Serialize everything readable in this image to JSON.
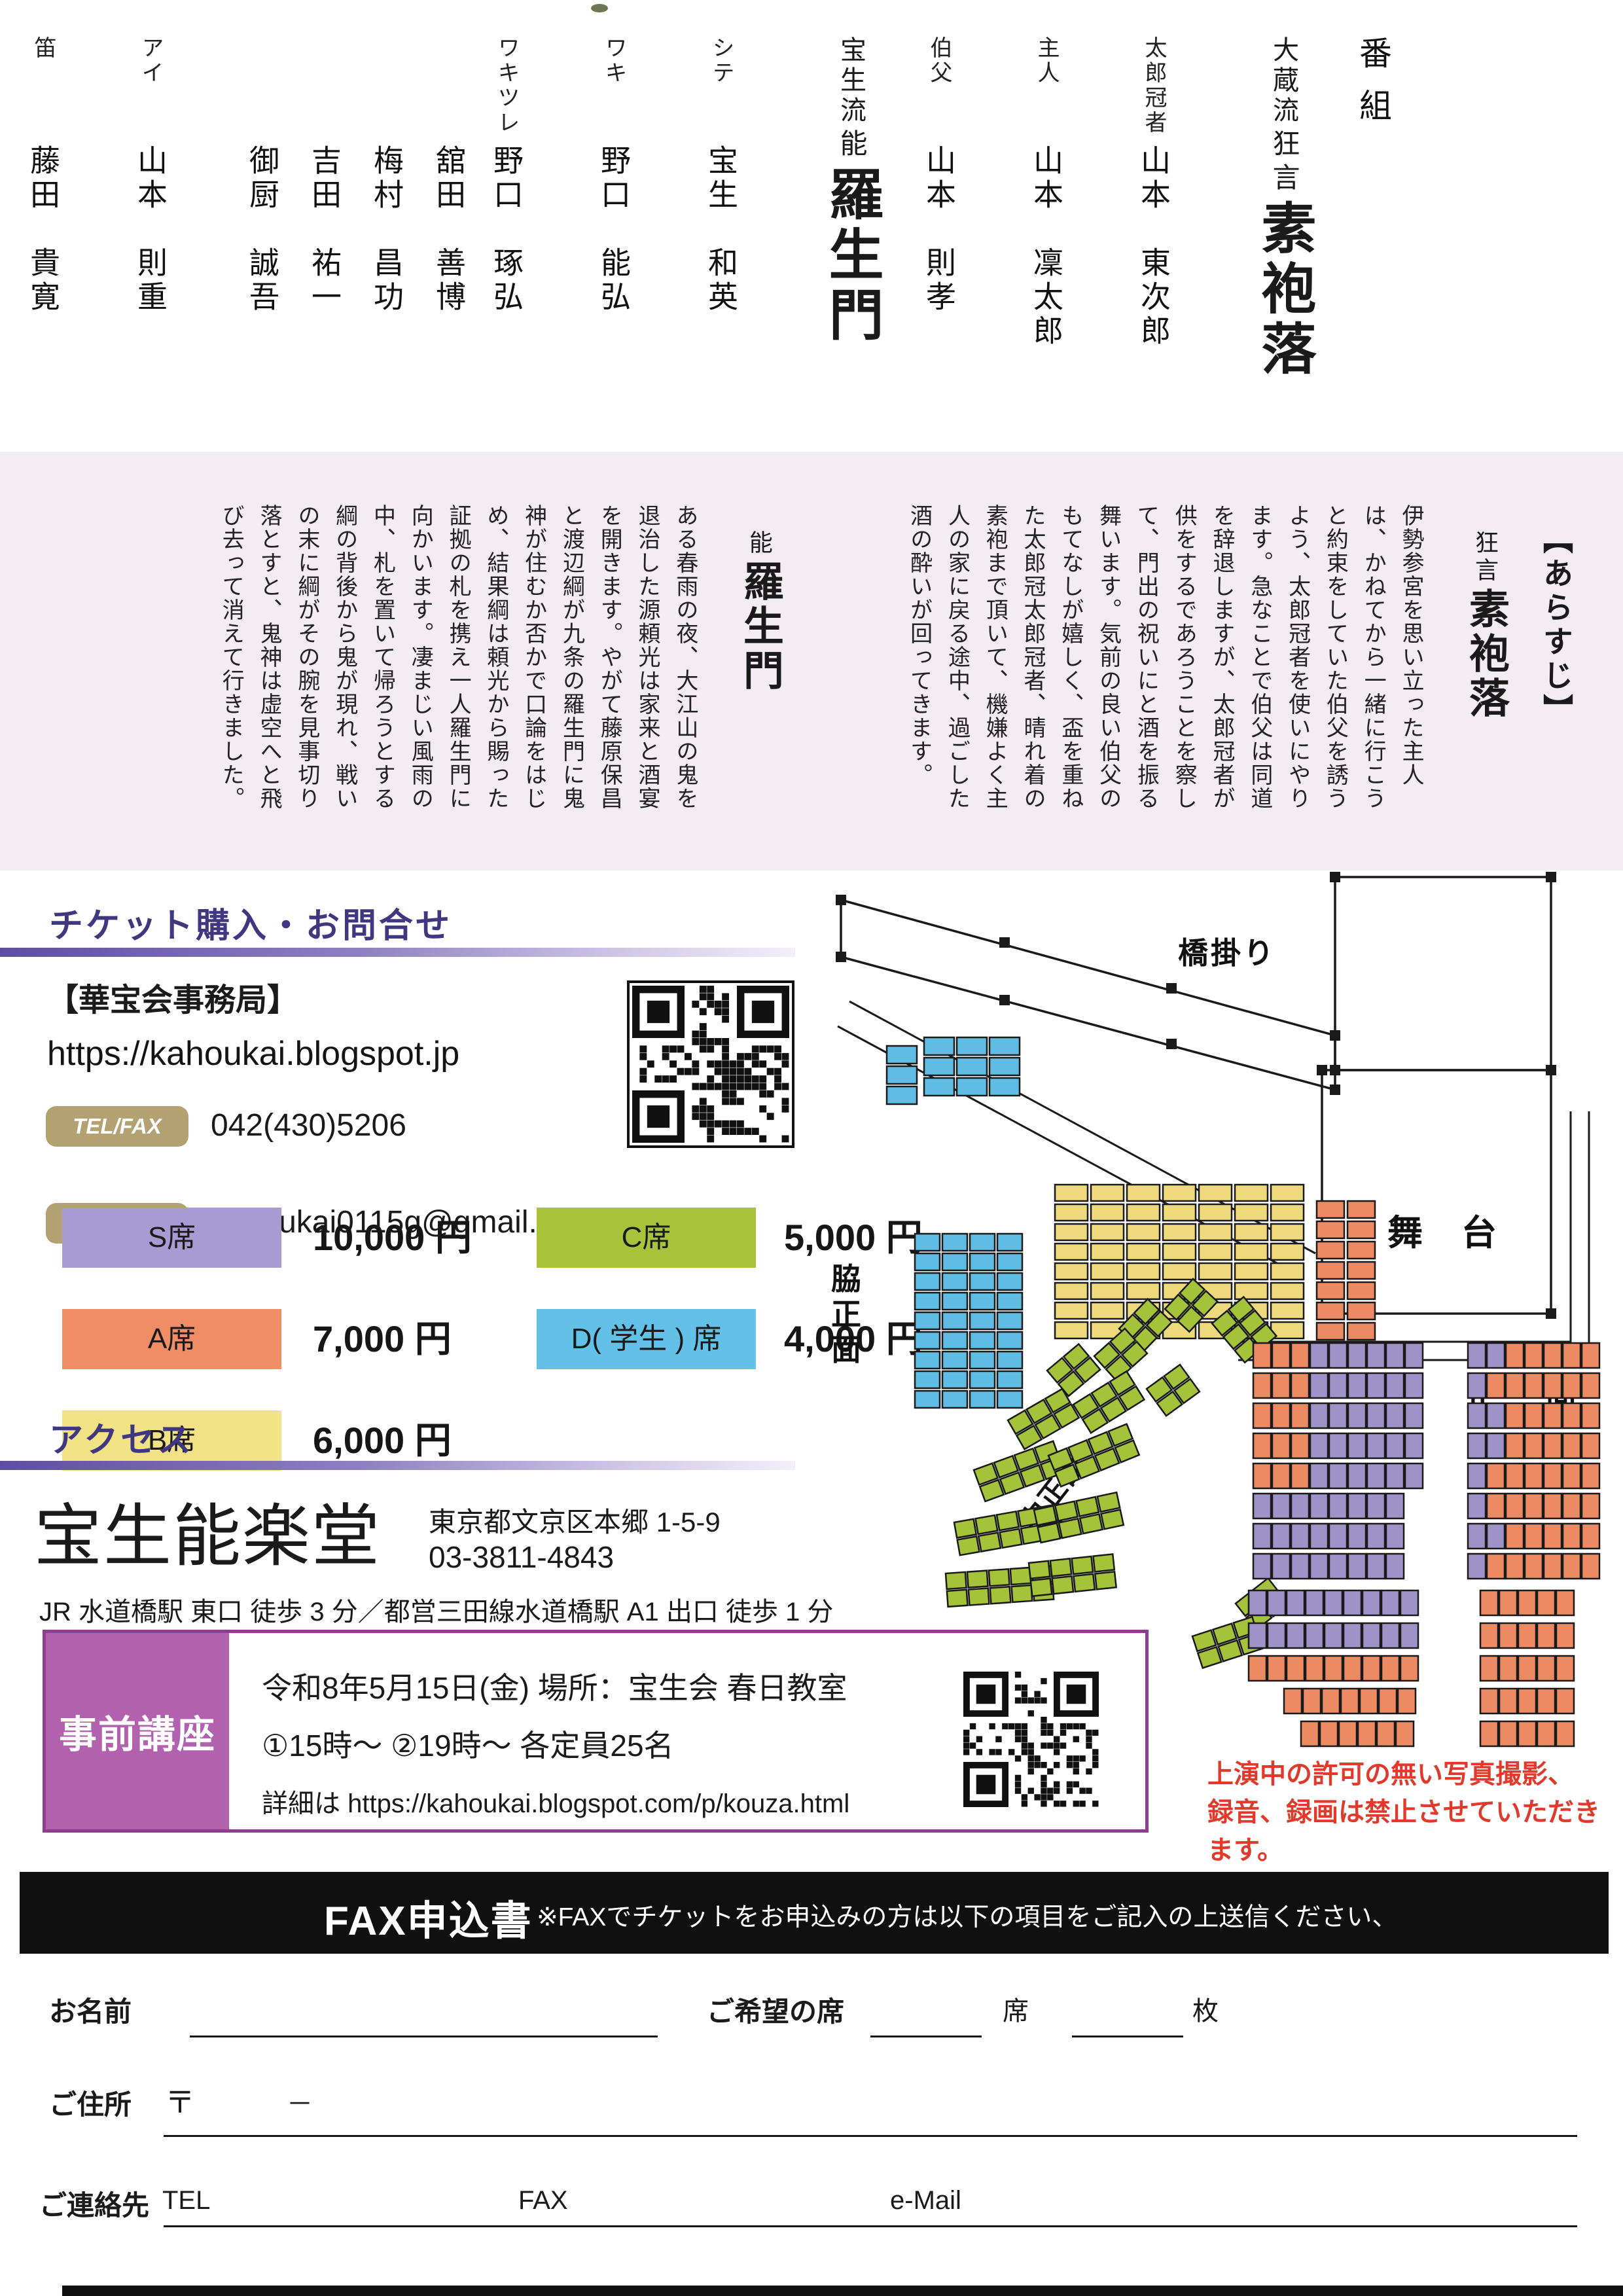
{
  "program": {
    "heading": "番組",
    "kyogen": {
      "school": "大蔵流",
      "genre": "狂言",
      "title": "素袍落",
      "cast": [
        {
          "role": "太郎冠者",
          "name": "山本　東次郎"
        },
        {
          "role": "主人",
          "name": "山本　凜太郎"
        },
        {
          "role": "伯父",
          "name": "山本　則孝"
        }
      ]
    },
    "noh": {
      "school": "宝生流",
      "genre": "能",
      "title": "羅生門",
      "cast": [
        {
          "role": "シテ",
          "name": "宝生　和英"
        },
        {
          "role": "ワキ",
          "name": "野口　能弘"
        },
        {
          "role": "ワキツレ",
          "name": "野口　琢弘"
        },
        {
          "role": "",
          "name": "舘田　善博"
        },
        {
          "role": "",
          "name": "梅村　昌功"
        },
        {
          "role": "",
          "name": "吉田　祐一"
        },
        {
          "role": "",
          "name": "御厨　誠吾"
        },
        {
          "role": "アイ",
          "name": "山本　則重"
        },
        {
          "role": "笛",
          "name": "藤田　貴寛"
        },
        {
          "role": "小鼓",
          "name": "幸　信吾"
        },
        {
          "role": "大鼓",
          "name": "柿原　弘和"
        },
        {
          "role": "太鼓",
          "name": "林　雄一郎"
        },
        {
          "role": "後見",
          "name": "内藤　飛能"
        },
        {
          "role": "",
          "name": "辰巳　和磨"
        },
        {
          "role": "",
          "name": "朝倉　大輔"
        },
        {
          "role": "",
          "name": "上野　能寛"
        },
        {
          "role": "ワキ後見",
          "name": "宝生　欣哉"
        },
        {
          "role": "地謡",
          "name": "鶴田　航己"
        },
        {
          "role": "",
          "name": "藤井　秋雅"
        },
        {
          "role": "",
          "name": "今井　基"
        },
        {
          "role": "",
          "name": "金野　泰大"
        },
        {
          "role": "",
          "name": "當山　淳司"
        },
        {
          "role": "",
          "name": "水上　優"
        },
        {
          "role": "",
          "name": "東川　尚史"
        },
        {
          "role": "",
          "name": "辰巳大二郎"
        }
      ]
    }
  },
  "synopsis": {
    "heading": "【あらすじ】",
    "kyogen": {
      "genre": "狂言",
      "title": "素袍落",
      "body": "伊勢参宮を思い立った主人は、かねてから一緒に行こうと約束をしていた伯父を誘うよう、太郎冠者を使いにやります。急なことで伯父は同道を辞退しますが、太郎冠者が供をするであろうことを察して、門出の祝いにと酒を振る舞います。気前の良い伯父のもてなしが嬉しく、盃を重ねた太郎冠太郎冠者、晴れ着の素袍まで頂いて、機嫌よく主人の家に戻る途中、過ごした酒の酔いが回ってきます。"
    },
    "noh": {
      "genre": "能",
      "title": "羅生門",
      "body": "ある春雨の夜、大江山の鬼を退治した源頼光は家来と酒宴を開きます。やがて藤原保昌と渡辺綱が九条の羅生門に鬼神が住むか否かで口論をはじめ、結果綱は頼光から賜った証拠の札を携え一人羅生門に向かいます。凄まじい風雨の中、札を置いて帰ろうとする綱の背後から鬼が現れ、戦いの末に綱がその腕を見事切り落とすと、鬼神は虚空へと飛び去って消えて行きました。"
    }
  },
  "ticket": {
    "heading": "チケット購入・お問合せ",
    "office": "【華宝会事務局】",
    "url": "https://kahoukai.blogspot.jp",
    "tel_label": "TEL/FAX",
    "tel": "042(430)5206",
    "mail_label": "MAIL",
    "mail": "kahoukai0115g@gmail.com",
    "prices_left": [
      {
        "label": "S席",
        "price": "10,000 円",
        "color": "#a89bd4"
      },
      {
        "label": "A席",
        "price": "7,000 円",
        "color": "#ee8d66"
      },
      {
        "label": "B席",
        "price": "6,000 円",
        "color": "#f1e286"
      }
    ],
    "prices_right": [
      {
        "label": "C席",
        "price": "5,000 円",
        "color": "#a9c23c"
      },
      {
        "label": "D( 学生 ) 席",
        "price": "4,000 円",
        "color": "#63c0e6"
      }
    ]
  },
  "access": {
    "heading": "アクセス",
    "venue": "宝生能楽堂",
    "address": "東京都文京区本郷 1-5-9",
    "phone": "03-3811-4843",
    "route": "JR 水道橋駅 東口 徒歩 3 分／都営三田線水道橋駅 A1 出口 徒歩 1 分"
  },
  "lecture": {
    "title": "事前講座",
    "line1": "令和8年5月15日(金)  場所：宝生会 春日教室",
    "line2": "①15時〜 ②19時〜 各定員25名",
    "line3": "詳細は https://kahoukai.blogspot.com/p/kouza.html"
  },
  "notice": {
    "line1": "上演中の許可の無い写真撮影、",
    "line2": "録音、録画は禁止させていただきます。"
  },
  "seatmap": {
    "bridge": "橋掛り",
    "stage": "舞 台",
    "front": "正  面",
    "side_front": "脇正面",
    "middle_front": "中正面",
    "colors": {
      "S": "#9e93c8",
      "A": "#eb8a63",
      "B": "#eeda7d",
      "C": "#a5c23b",
      "D": "#5fbce3"
    }
  },
  "fax": {
    "bar_title": "FAX申込書",
    "bar_note": "※FAXでチケットをお申込みの方は以下の項目をご記入の上送信ください、",
    "name_label": "お名前",
    "seat_label": "ご希望の席",
    "seat_unit": "席",
    "count_unit": "枚",
    "addr_label": "ご住所",
    "postal_mark": "〒",
    "postal_dash": "－",
    "contact_label": "ご連絡先",
    "tel_label": "TEL",
    "fax_label": "FAX",
    "mail_label": "e-Mail"
  }
}
